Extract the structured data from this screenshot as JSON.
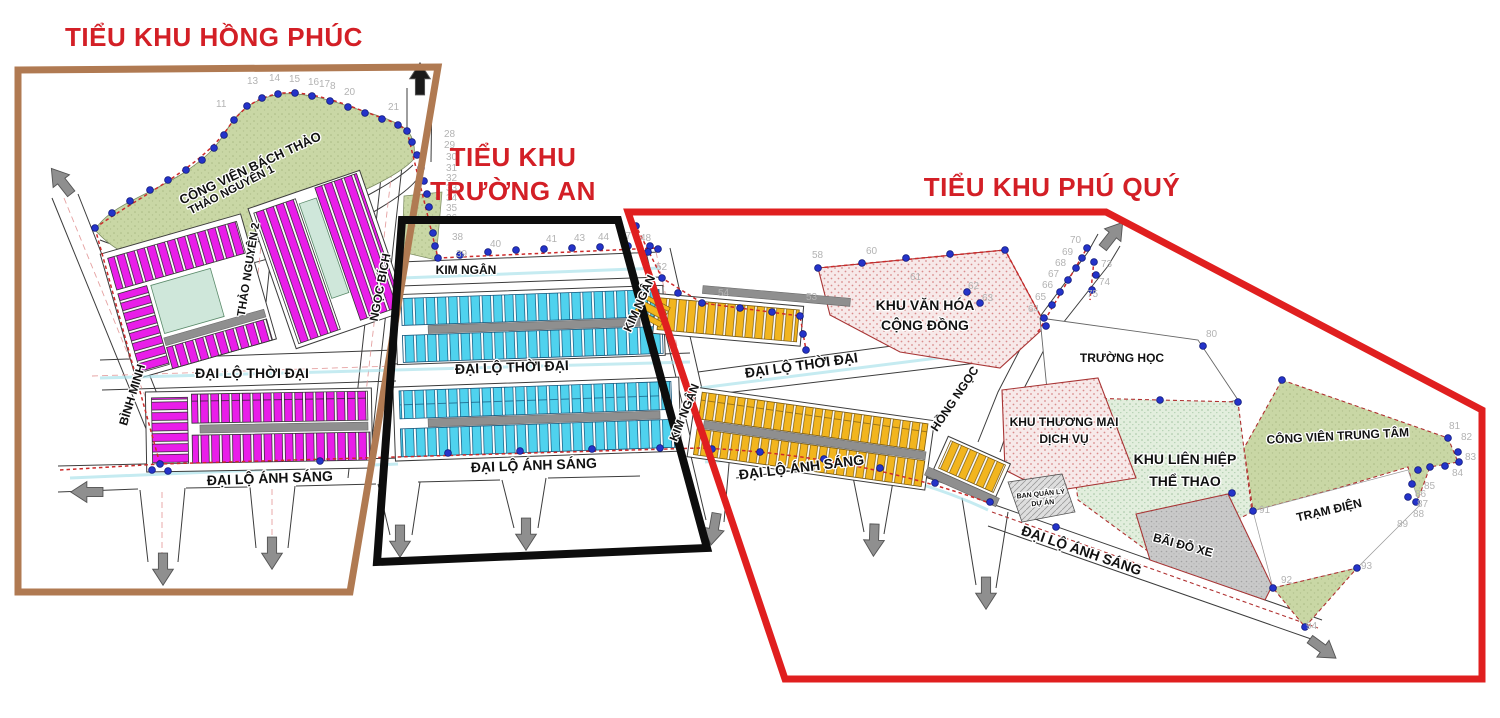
{
  "zones": {
    "hong_phuc": {
      "title": "TIỂU KHU HỒNG PHÚC",
      "border_color": "#b07a52"
    },
    "truong_an": {
      "title_line1": "TIỂU KHU",
      "title_line2": "TRƯỜNG AN",
      "border_color": "#0d0d0d"
    },
    "phu_quy": {
      "title": "TIỂU KHU PHÚ QUÝ",
      "border_color": "#e01f1f"
    }
  },
  "streets": {
    "binh_minh": "BÌNH MINH",
    "thao_nguyen_1": "THẢO NGUYÊN 1",
    "thao_nguyen_2": "THẢO NGUYÊN 2",
    "ngoc_bich": "NGỌC BÍCH",
    "kim_ngan": "KIM NGÂN",
    "dai_lo_thoi_dai": "ĐẠI LỘ THỜI ĐẠI",
    "dai_lo_anh_sang": "ĐẠI LỘ ÁNH SÁNG",
    "hong_ngoc": "HỒNG NGỌC"
  },
  "areas": {
    "cong_vien_bach_thao": "CÔNG VIÊN BÁCH THẢO",
    "khu_van_hoa_line1": "KHU VĂN HÓA",
    "khu_van_hoa_line2": "CỘNG ĐỒNG",
    "truong_hoc": "TRƯỜNG HỌC",
    "khu_thuong_mai_line1": "KHU THƯƠNG MẠI",
    "khu_thuong_mai_line2": "DỊCH VỤ",
    "khu_lien_hiep_line1": "KHU LIÊN HIỆP",
    "khu_lien_hiep_line2": "THỂ THAO",
    "cong_vien_trung_tam": "CÔNG VIÊN TRUNG TÂM",
    "tram_dien": "TRẠM ĐIỆN",
    "bai_do_xe": "BÃI ĐỖ XE",
    "ban_quan_ly_line1": "BAN QUẢN LÝ",
    "ban_quan_ly_line2": "DỰ ÁN"
  },
  "colors": {
    "lot_hong_phuc": "#e91ee9",
    "lot_truong_an": "#4fd2ee",
    "lot_phu_quy": "#f2b51e",
    "park_green": "#c9d7a5",
    "sport_green": "#e2eedd",
    "culture_pink": "#f7e9e9",
    "title_red": "#d31f26"
  },
  "survey_points": [
    {
      "n": "11",
      "x": 216,
      "y": 107
    },
    {
      "n": "13",
      "x": 247,
      "y": 84
    },
    {
      "n": "14",
      "x": 269,
      "y": 81
    },
    {
      "n": "15",
      "x": 289,
      "y": 82
    },
    {
      "n": "16",
      "x": 308,
      "y": 85
    },
    {
      "n": "17",
      "x": 319,
      "y": 87
    },
    {
      "n": "8",
      "x": 330,
      "y": 89
    },
    {
      "n": "20",
      "x": 344,
      "y": 95
    },
    {
      "n": "21",
      "x": 388,
      "y": 110
    },
    {
      "n": "28",
      "x": 444,
      "y": 137
    },
    {
      "n": "29",
      "x": 444,
      "y": 148
    },
    {
      "n": "30",
      "x": 446,
      "y": 160
    },
    {
      "n": "31",
      "x": 446,
      "y": 171
    },
    {
      "n": "32",
      "x": 446,
      "y": 181
    },
    {
      "n": "33",
      "x": 446,
      "y": 191
    },
    {
      "n": "34",
      "x": 446,
      "y": 201
    },
    {
      "n": "35",
      "x": 446,
      "y": 211
    },
    {
      "n": "36",
      "x": 446,
      "y": 221
    },
    {
      "n": "38",
      "x": 452,
      "y": 240
    },
    {
      "n": "39",
      "x": 456,
      "y": 257
    },
    {
      "n": "40",
      "x": 490,
      "y": 247
    },
    {
      "n": "41",
      "x": 546,
      "y": 242
    },
    {
      "n": "43",
      "x": 574,
      "y": 241
    },
    {
      "n": "44",
      "x": 598,
      "y": 240
    },
    {
      "n": "47",
      "x": 620,
      "y": 239
    },
    {
      "n": "48",
      "x": 640,
      "y": 241
    },
    {
      "n": "52",
      "x": 656,
      "y": 270
    },
    {
      "n": "54",
      "x": 718,
      "y": 296
    },
    {
      "n": "53",
      "x": 806,
      "y": 300
    },
    {
      "n": "58",
      "x": 812,
      "y": 258
    },
    {
      "n": "60",
      "x": 866,
      "y": 254
    },
    {
      "n": "61",
      "x": 910,
      "y": 280
    },
    {
      "n": "62",
      "x": 968,
      "y": 289
    },
    {
      "n": "63",
      "x": 982,
      "y": 301
    },
    {
      "n": "64",
      "x": 1028,
      "y": 312
    },
    {
      "n": "65",
      "x": 1035,
      "y": 300
    },
    {
      "n": "66",
      "x": 1042,
      "y": 288
    },
    {
      "n": "67",
      "x": 1048,
      "y": 277
    },
    {
      "n": "68",
      "x": 1055,
      "y": 266
    },
    {
      "n": "69",
      "x": 1062,
      "y": 255
    },
    {
      "n": "70",
      "x": 1070,
      "y": 243
    },
    {
      "n": "73",
      "x": 1101,
      "y": 267
    },
    {
      "n": "74",
      "x": 1099,
      "y": 285
    },
    {
      "n": "75",
      "x": 1087,
      "y": 297
    },
    {
      "n": "80",
      "x": 1206,
      "y": 337
    },
    {
      "n": "81",
      "x": 1449,
      "y": 429
    },
    {
      "n": "82",
      "x": 1461,
      "y": 440
    },
    {
      "n": "83",
      "x": 1465,
      "y": 460
    },
    {
      "n": "84",
      "x": 1452,
      "y": 476
    },
    {
      "n": "85",
      "x": 1424,
      "y": 489
    },
    {
      "n": "86",
      "x": 1415,
      "y": 497
    },
    {
      "n": "87",
      "x": 1417,
      "y": 507
    },
    {
      "n": "88",
      "x": 1413,
      "y": 517
    },
    {
      "n": "89",
      "x": 1397,
      "y": 527
    },
    {
      "n": "91",
      "x": 1259,
      "y": 513
    },
    {
      "n": "92",
      "x": 1281,
      "y": 583
    },
    {
      "n": "93",
      "x": 1361,
      "y": 569
    },
    {
      "n": "94",
      "x": 1306,
      "y": 629
    }
  ]
}
